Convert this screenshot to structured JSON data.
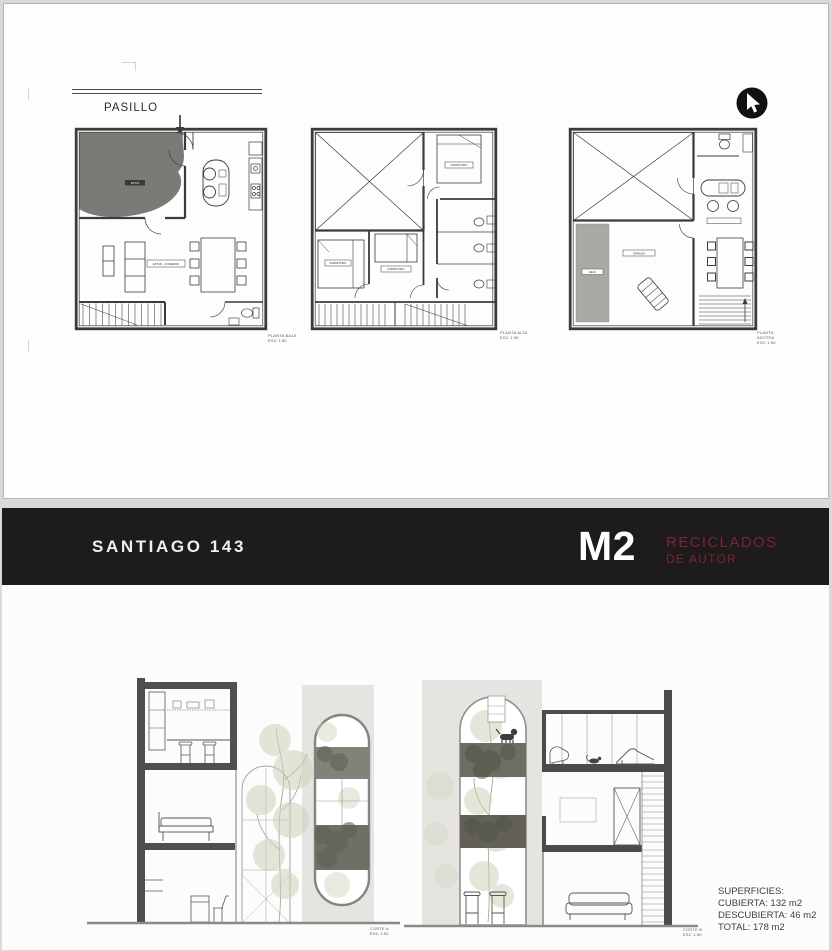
{
  "top_panel": {
    "corridor_label": "PASILLO",
    "north_icon": "cursor-pointer-icon",
    "plans": [
      {
        "caption": [
          "PLANTA BAJA",
          "ESC 1:50"
        ],
        "labels": {
          "patio": "PATIO",
          "room": "ESTAR - COMEDOR"
        }
      },
      {
        "caption": [
          "PLANTA ALTA",
          "ESC 1:50"
        ],
        "labels": {
          "bed1": "DORMITORIO",
          "bed2": "DORMITORIO",
          "bed3": "DORMITORIO"
        }
      },
      {
        "caption": [
          "PLANTA",
          "AZOTEA",
          "ESC 1:50"
        ],
        "labels": {
          "deck": "DECK",
          "terrace": "TERRAZA"
        }
      }
    ]
  },
  "footer_panel": {
    "header": {
      "title": "SANTIAGO 143",
      "logo_main": "M2",
      "logo_line1": "RECICLADOS",
      "logo_line2": "DE AUTOR"
    },
    "sections": [
      {
        "caption": [
          "CORTE A",
          "ESC 1:50"
        ]
      },
      {
        "caption": [
          "CORTE B",
          "ESC 1:50"
        ]
      }
    ],
    "surfaces": {
      "heading": "SUPERFICIES:",
      "items": [
        "CUBIERTA: 132 m2",
        "DESCUBIERTA: 46 m2",
        "TOTAL: 178 m2"
      ]
    }
  },
  "colors": {
    "header_bar": "#1d1b1b",
    "logo_red": "#7d2431",
    "patio_gray": "#7b7a77",
    "deck_gray": "#a9a8a3",
    "facade_gray": "#e5e4e1",
    "poche_gray": "#4f4f4c",
    "vegetation_green": "#c9d0b4"
  }
}
